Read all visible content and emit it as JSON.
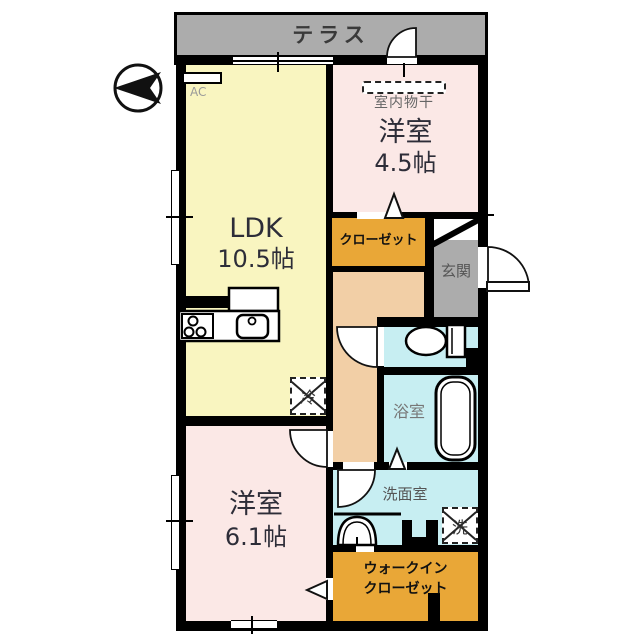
{
  "plan_title": "2LDK apartment floor plan",
  "terrace": {
    "label": "テラス"
  },
  "rooms": {
    "ldk": {
      "name": "LDK",
      "size": "10.5帖"
    },
    "western_45": {
      "name": "洋室",
      "size": "4.5帖"
    },
    "western_61": {
      "name": "洋室",
      "size": "6.1帖"
    },
    "bath": {
      "label": "浴室"
    },
    "washroom": {
      "label": "洗面室"
    },
    "entrance": {
      "label": "玄関"
    },
    "closet": {
      "label": "クローゼット"
    },
    "walk_in_closet": {
      "line1": "ウォークイン",
      "line2": "クローゼット"
    }
  },
  "fixtures": {
    "ac": "AC",
    "indoor_drying": "室内物干",
    "refrigerator": "冷",
    "washer": "洗"
  },
  "colors": {
    "wall": "#000000",
    "terrace_gray": "#acacac",
    "entrance_gray": "#acacac",
    "ldk_yellow": "#f9f5c0",
    "bedroom_pink": "#fbe8e6",
    "hall_peach": "#f2cfa6",
    "closet_orange": "#e9a737",
    "water_aqua": "#c7eef2"
  }
}
